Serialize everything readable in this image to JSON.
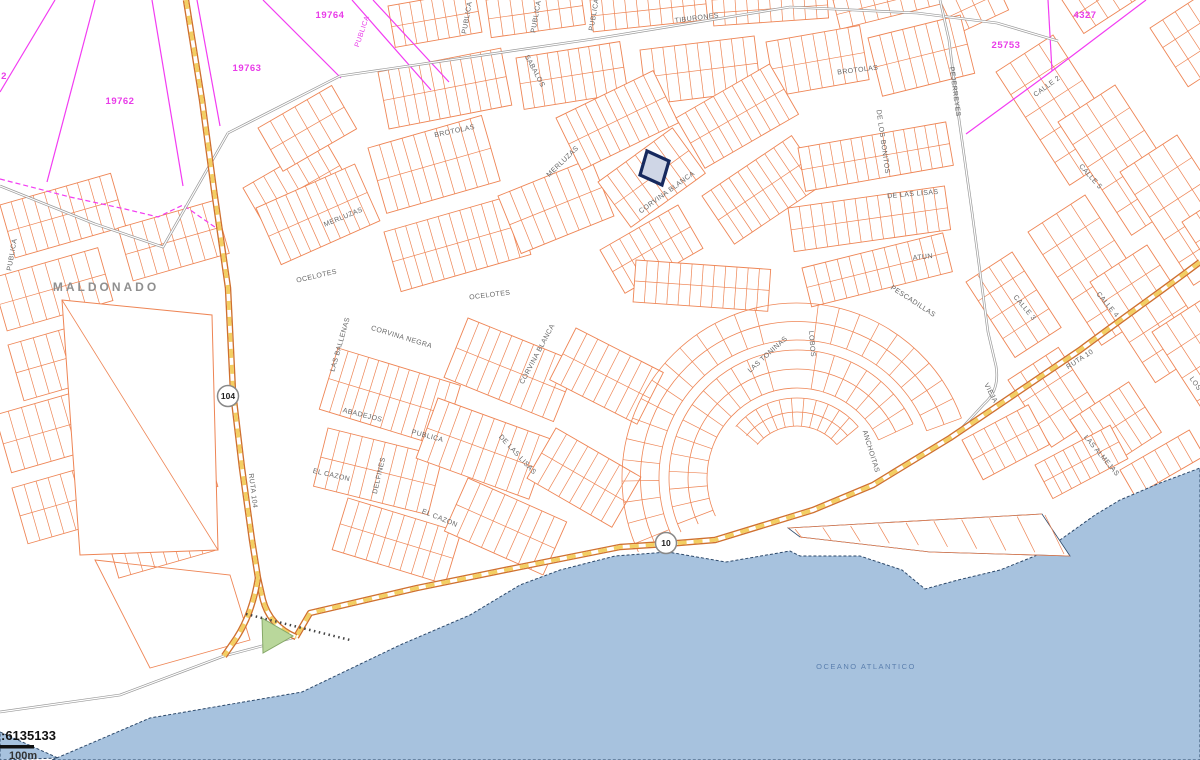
{
  "map": {
    "place_label": "MALDONADO",
    "ocean_label": "OCEANO ATLANTICO",
    "scale": {
      "ratio_text": ":6135133",
      "bar_label": "100m"
    },
    "route_shields": [
      {
        "number": "104",
        "x": 228,
        "y": 396
      },
      {
        "number": "10",
        "x": 666,
        "y": 543
      }
    ],
    "parcel_numbers": [
      {
        "t": "19764",
        "x": 330,
        "y": 18
      },
      {
        "t": "19763",
        "x": 247,
        "y": 71
      },
      {
        "t": "19762",
        "x": 120,
        "y": 104
      },
      {
        "t": "2",
        "x": 4,
        "y": 79
      },
      {
        "t": "25753",
        "x": 1006,
        "y": 48
      },
      {
        "t": "4327",
        "x": 1085,
        "y": 18
      }
    ],
    "street_labels": [
      {
        "t": "TIBURONES",
        "x": 697,
        "y": 20,
        "r": -7,
        "c": "street"
      },
      {
        "t": "BROTOLAS",
        "x": 455,
        "y": 133,
        "r": -12,
        "c": "street"
      },
      {
        "t": "BROTOLAS",
        "x": 858,
        "y": 72,
        "r": -7,
        "c": "street"
      },
      {
        "t": "SABALOS",
        "x": 533,
        "y": 72,
        "r": 62,
        "c": "street"
      },
      {
        "t": "MERLUZAS",
        "x": 564,
        "y": 163,
        "r": -44,
        "c": "street"
      },
      {
        "t": "MERLUZAS",
        "x": 344,
        "y": 219,
        "r": -22,
        "c": "street"
      },
      {
        "t": "OCELOTES",
        "x": 317,
        "y": 278,
        "r": -13,
        "c": "street"
      },
      {
        "t": "OCELOTES",
        "x": 490,
        "y": 297,
        "r": -7,
        "c": "street"
      },
      {
        "t": "CORVINA BLANCA",
        "x": 668,
        "y": 194,
        "r": -36,
        "c": "street"
      },
      {
        "t": "CORVINA BLANCA",
        "x": 539,
        "y": 355,
        "r": -62,
        "c": "street"
      },
      {
        "t": "CORVINA NEGRA",
        "x": 401,
        "y": 339,
        "r": 17,
        "c": "street"
      },
      {
        "t": "LAS BALLENAS",
        "x": 342,
        "y": 345,
        "r": -74,
        "c": "street"
      },
      {
        "t": "ABADEJOS",
        "x": 362,
        "y": 417,
        "r": 14,
        "c": "street"
      },
      {
        "t": "PUBLICA",
        "x": 427,
        "y": 438,
        "r": 15,
        "c": "street"
      },
      {
        "t": "DELFINES",
        "x": 381,
        "y": 476,
        "r": -77,
        "c": "street"
      },
      {
        "t": "EL CAZON",
        "x": 331,
        "y": 477,
        "r": 13,
        "c": "street"
      },
      {
        "t": "EL CAZON",
        "x": 439,
        "y": 520,
        "r": 22,
        "c": "street"
      },
      {
        "t": "DE LAS LISAS",
        "x": 913,
        "y": 196,
        "r": -5,
        "c": "street"
      },
      {
        "t": "DE LAS LISAS",
        "x": 516,
        "y": 456,
        "r": 47,
        "c": "street"
      },
      {
        "t": "DE LOS BONITOS",
        "x": 881,
        "y": 142,
        "r": 82,
        "c": "street"
      },
      {
        "t": "ATUN",
        "x": 923,
        "y": 259,
        "r": -6,
        "c": "street"
      },
      {
        "t": "PESCADILLAS",
        "x": 912,
        "y": 303,
        "r": 33,
        "c": "street"
      },
      {
        "t": "LAS TONINAS",
        "x": 769,
        "y": 356,
        "r": -42,
        "c": "street"
      },
      {
        "t": "LOBOS",
        "x": 810,
        "y": 344,
        "r": 85,
        "c": "street"
      },
      {
        "t": "ANCHOITAS",
        "x": 869,
        "y": 452,
        "r": 73,
        "c": "street"
      },
      {
        "t": "PEJERREYES",
        "x": 953,
        "y": 92,
        "r": 82,
        "c": "street"
      },
      {
        "t": "CALLE 2",
        "x": 1048,
        "y": 88,
        "r": -36,
        "c": "street"
      },
      {
        "t": "CALLE 5",
        "x": 1089,
        "y": 178,
        "r": 48,
        "c": "street"
      },
      {
        "t": "CALLE 3",
        "x": 1023,
        "y": 309,
        "r": 50,
        "c": "street"
      },
      {
        "t": "CALLE 4",
        "x": 1106,
        "y": 306,
        "r": 50,
        "c": "street"
      },
      {
        "t": "RUTA 10",
        "x": 1081,
        "y": 361,
        "r": -33,
        "c": "street"
      },
      {
        "t": "VIEJA",
        "x": 989,
        "y": 394,
        "r": 62,
        "c": "street"
      },
      {
        "t": "LAS ALMEJAS",
        "x": 1100,
        "y": 457,
        "r": 50,
        "c": "street"
      },
      {
        "t": "LOS C",
        "x": 1196,
        "y": 388,
        "r": 55,
        "c": "street"
      },
      {
        "t": "RUTA 104",
        "x": 251,
        "y": 491,
        "r": 83,
        "c": "street"
      },
      {
        "t": "PUBLICA",
        "x": 469,
        "y": 18,
        "r": -80,
        "c": "street"
      },
      {
        "t": "PUBLICA",
        "x": 538,
        "y": 17,
        "r": -80,
        "c": "street"
      },
      {
        "t": "PUBLICA",
        "x": 596,
        "y": 15,
        "r": -80,
        "c": "street"
      },
      {
        "t": "PUBLICA",
        "x": 14,
        "y": 255,
        "r": -80,
        "c": "street"
      },
      {
        "t": "PUBLICA",
        "x": 364,
        "y": 32,
        "r": -71,
        "c": "mstreet"
      }
    ],
    "colors": {
      "parcel_line": "#ee8555",
      "cadastral_line": "#f23cf2",
      "road_casing": "#cf7030",
      "road_dash": "#f3cf63",
      "gray_road": "#9a9a9a",
      "water_fill": "#a7c2de",
      "water_edge": "#2e4a6b",
      "street_text": "#666666",
      "highlight_stroke": "#16295e",
      "highlight_fill": "#cfd6e6",
      "green_area": "#b9d79b"
    }
  }
}
